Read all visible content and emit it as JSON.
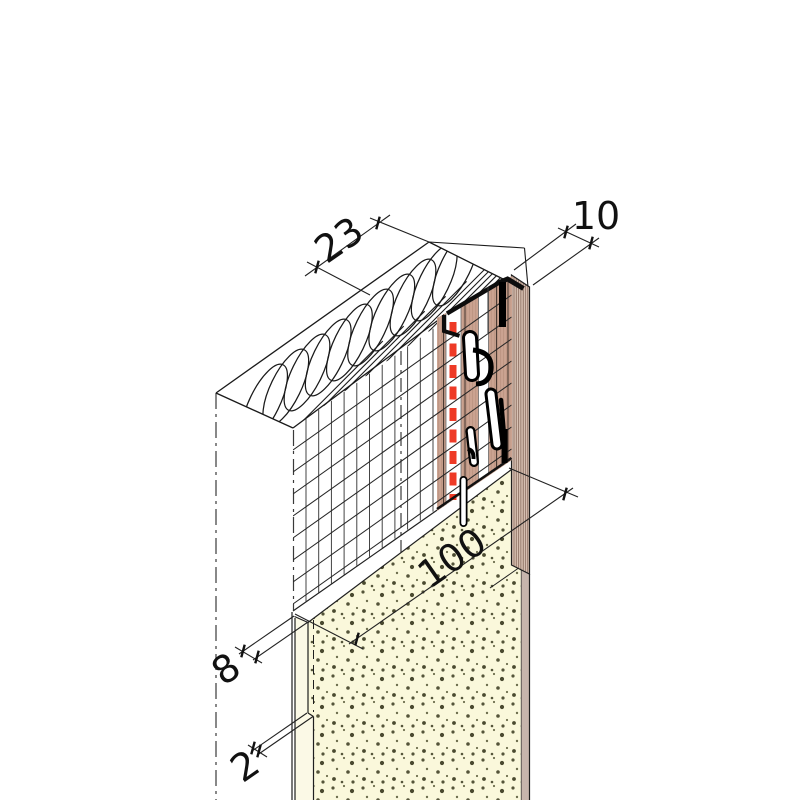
{
  "drawing": {
    "dimensions": {
      "system_thickness": {
        "label": "23"
      },
      "profile_face": {
        "label": "10"
      },
      "profile_length": {
        "label": "100"
      },
      "render_base": {
        "label": "8"
      },
      "render_finish": {
        "label": "2"
      }
    },
    "colors": {
      "profile_tan": "#CBA391",
      "marker_red": "#EE3A26",
      "masonry_cream": "#FAF8DB",
      "masonry_strip": "#FBF9E6",
      "edge_band": "#DAC3B5",
      "wall_return": "#C7B5AC"
    }
  }
}
